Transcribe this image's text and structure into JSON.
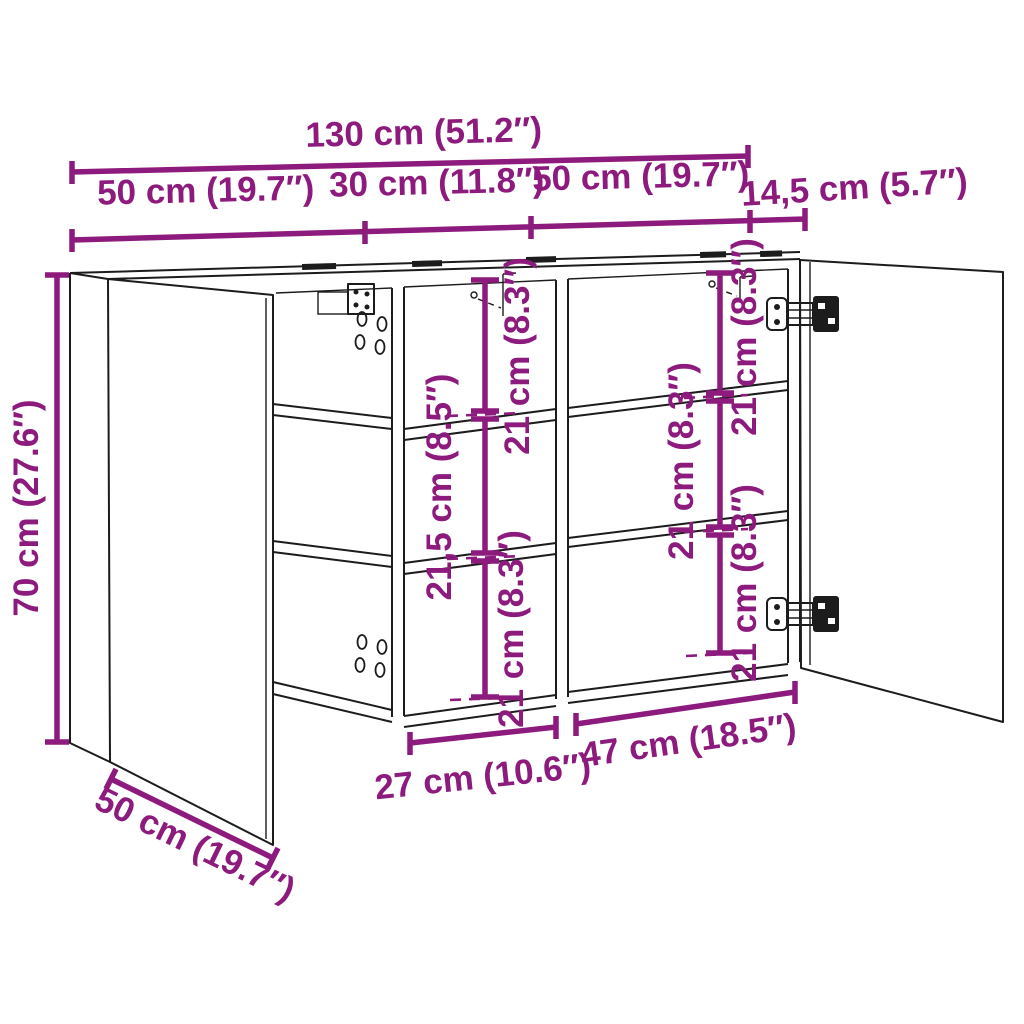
{
  "diagram": {
    "type": "furniture-dimension-diagram",
    "subject": "wall mirror cabinet with two open doors and shelves",
    "background_color": "#ffffff",
    "line_color": "#1c1c1c",
    "dimension_color": "#8D1A7D",
    "units": [
      "cm",
      "inches"
    ]
  },
  "dims": {
    "total_width": "130 cm (51.2″)",
    "seg_left": "50 cm (19.7″)",
    "seg_middle": "30 cm (11.8″)",
    "seg_right": "50 cm (19.7″)",
    "depth": "14,5 cm (5.7″)",
    "height": "70 cm (27.6″)",
    "door_diag": "50 cm (19.7″)",
    "mid_top": "21 cm (8.3″)",
    "mid_center": "21,5 cm (8.5″)",
    "mid_bottom": "21 cm (8.3″)",
    "right_top": "21 cm (8.3″)",
    "right_center": "21 cm (8.3″)",
    "right_bottom": "21 cm (8.3″)",
    "bottom_mid_width": "27 cm (10.6″)",
    "bottom_right_width": "47 cm (18.5″)"
  }
}
